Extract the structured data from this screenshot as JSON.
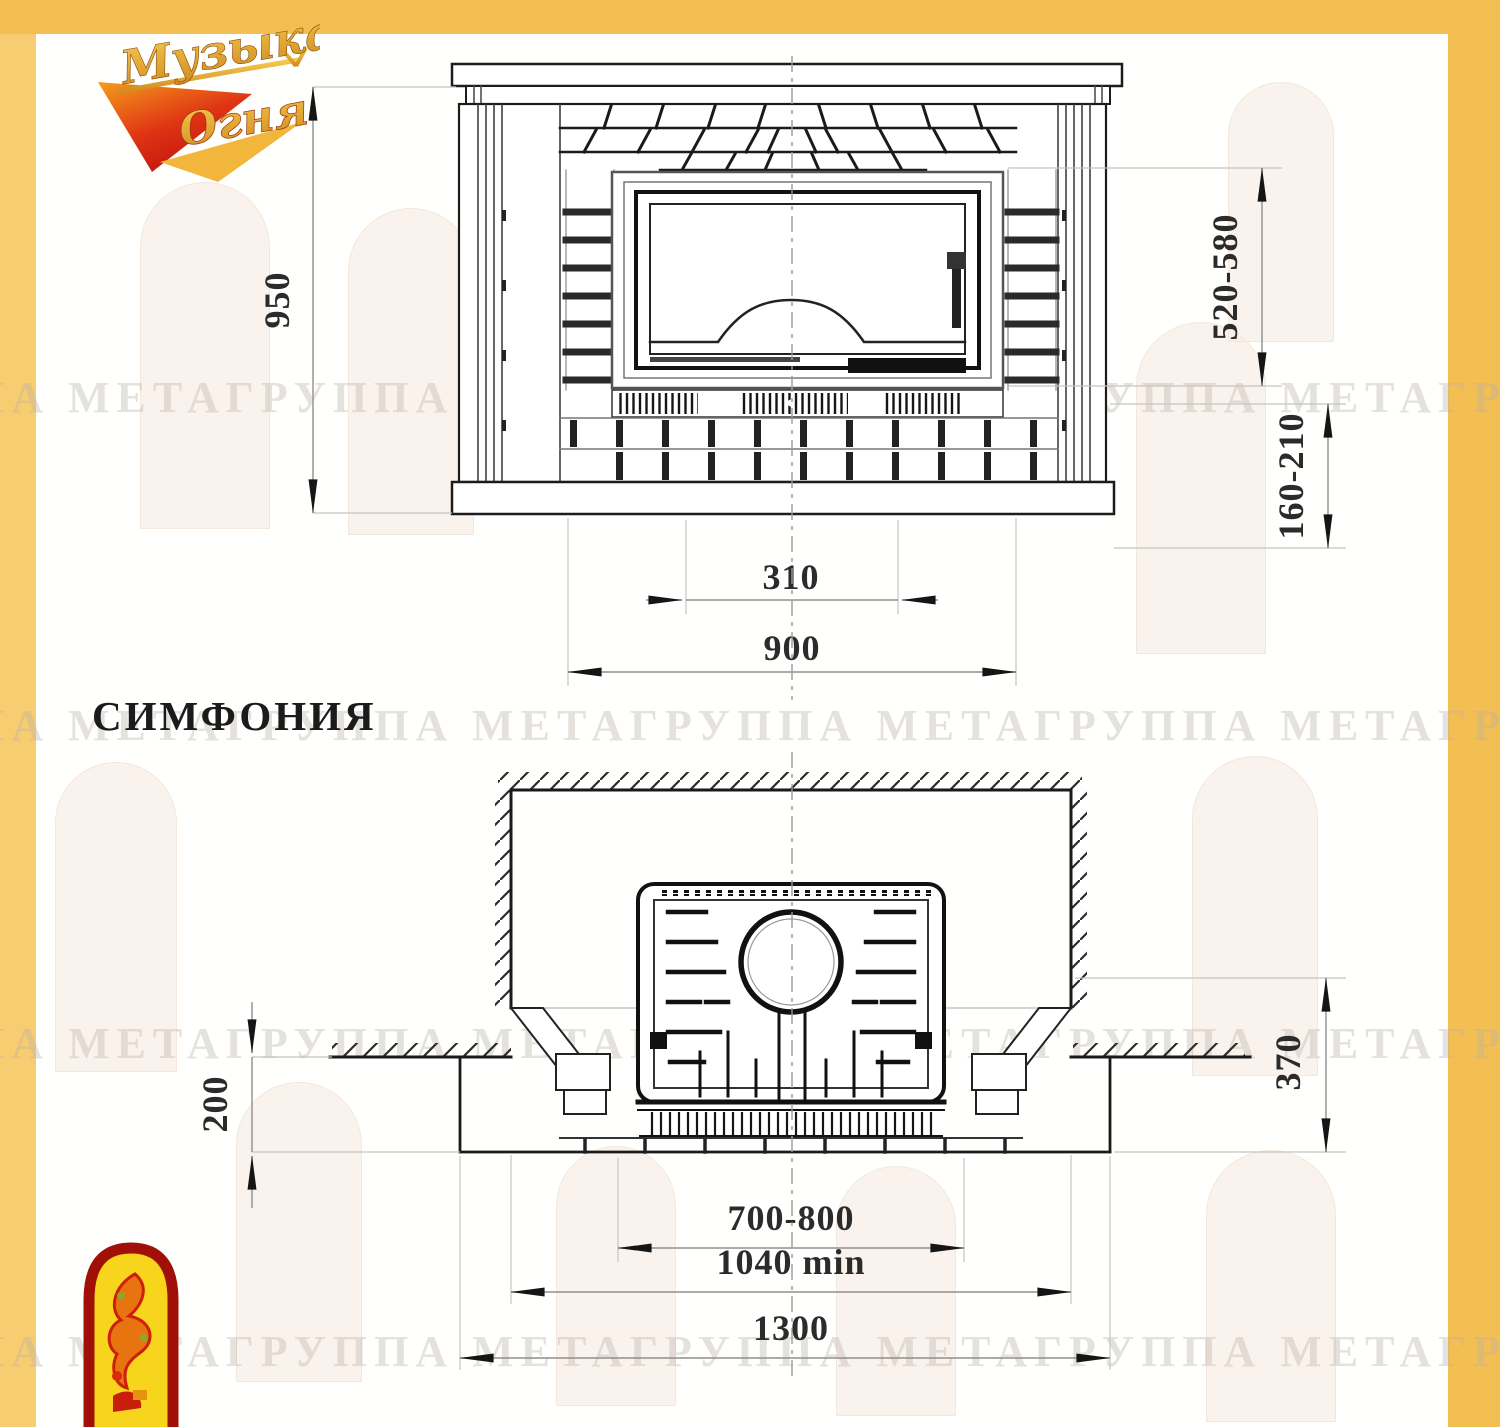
{
  "colors": {
    "frame_gold": "#F3BF53",
    "frame_gold_light": "#F8CD72",
    "drawing_ink": "#1c1c1c",
    "dimension_text": "#2b2b2b",
    "watermark_gray": "#b7afa5",
    "logo_red": "#D6231A",
    "logo_gold": "#E8A93D",
    "emblem_yellow": "#F6D51C",
    "emblem_dark_red": "#A01008"
  },
  "logo": {
    "word1": "Музыка",
    "word2": "Огня"
  },
  "watermark": {
    "text": "ПА МЕТАГРУППА МЕТАГРУППА МЕТАГРУППА МЕТАГРУППА МЕТА"
  },
  "title": {
    "label": "СИМФОНИЯ"
  },
  "front_view": {
    "dims": {
      "overall_height": "950",
      "opening_height": "520-580",
      "base_height": "160-210",
      "grate_width": "310",
      "body_width": "900"
    }
  },
  "plan_view": {
    "dims": {
      "hearth_front_depth": "200",
      "niche_to_hearth_front": "370",
      "insert_width": "700-800",
      "niche_width": "1040 min",
      "hearth_width": "1300"
    }
  }
}
